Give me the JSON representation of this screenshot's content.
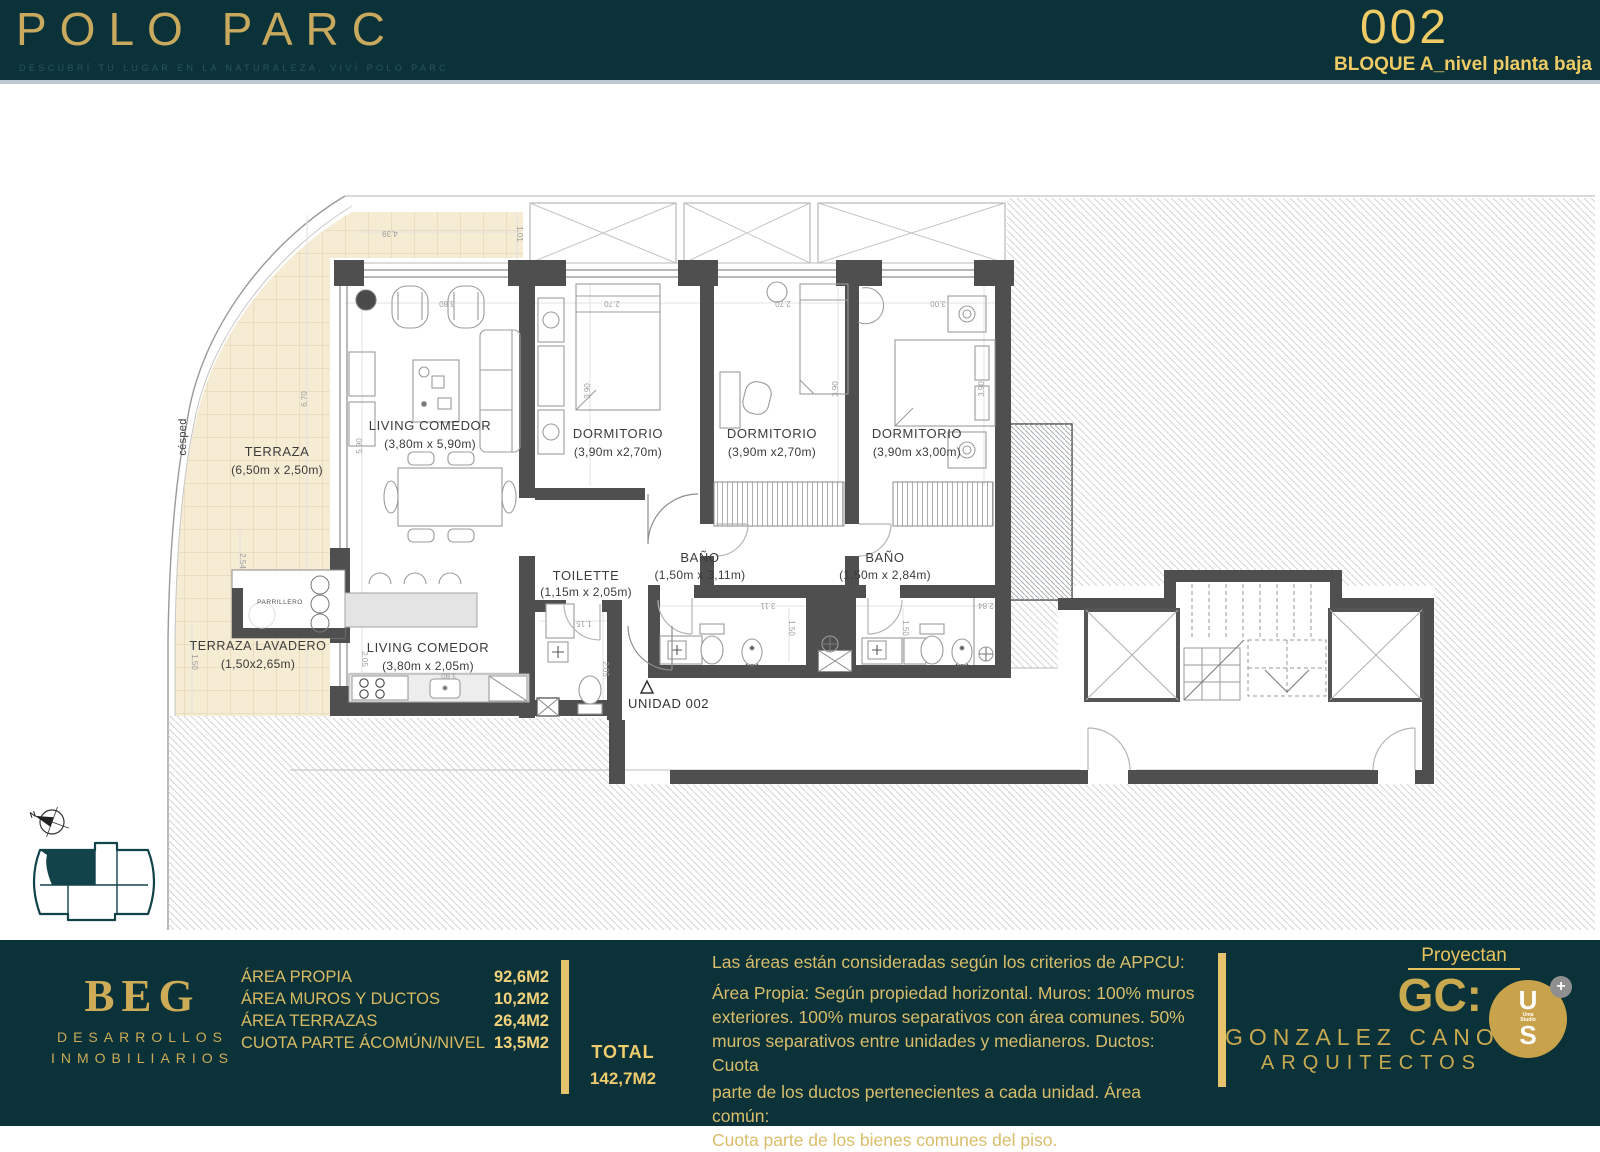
{
  "header": {
    "brand": "POLO PARC",
    "tagline": "DESCUBRÍ TU LUGAR EN LA NATURALEZA, VIVÍ POLO PARC.",
    "unit_number": "002",
    "block_label": "BLOQUE A_nivel planta baja"
  },
  "plan": {
    "rooms": {
      "terraza": {
        "name": "TERRAZA",
        "size": "(6,50m x 2,50m)"
      },
      "living": {
        "name": "LIVING COMEDOR",
        "size": "(3,80m x 5,90m)"
      },
      "dorm1": {
        "name": "DORMITORIO",
        "size": "(3,90m x2,70m)"
      },
      "dorm2": {
        "name": "DORMITORIO",
        "size": "(3,90m x2,70m)"
      },
      "dorm3": {
        "name": "DORMITORIO",
        "size": "(3,90m x3,00m)"
      },
      "toilette": {
        "name": "TOILETTE",
        "size": "(1,15m x 2,05m)"
      },
      "bano1": {
        "name": "BAÑO",
        "size": "(1,50m x 3,11m)"
      },
      "bano2": {
        "name": "BAÑO",
        "size": "(1,50m x 2,84m)"
      },
      "kitchen": {
        "name": "LIVING COMEDOR",
        "size": "(3,80m x 2,05m)"
      },
      "lavadero": {
        "name": "TERRAZA LAVADERO",
        "size": "(1,50x2,65m)"
      },
      "parrillero": {
        "name": "PARRILLERO"
      },
      "cesped": {
        "name": "césped"
      }
    },
    "unit_label": "UNIDAD 002",
    "compass_n": "N",
    "dims": [
      "4.39",
      "1.01",
      "3.80",
      "2.70",
      "2.70",
      "3.00",
      "6.70",
      "5.90",
      "3.90",
      "3.90",
      "3.90",
      "2.54",
      "1.50",
      "1.15",
      "2.05",
      "3.11",
      "1.50",
      "2.84",
      "1.50",
      "2.05",
      "3.80"
    ]
  },
  "footer": {
    "developer": {
      "name": "BEG",
      "line1": "DESARROLLOS",
      "line2": "INMOBILIARIOS"
    },
    "areas": [
      {
        "label": "ÁREA PROPIA",
        "value": "92,6M2"
      },
      {
        "label": "ÁREA MUROS Y DUCTOS",
        "value": "10,2M2"
      },
      {
        "label": "ÁREA TERRAZAS",
        "value": "26,4M2"
      },
      {
        "label": "CUOTA PARTE ÁCOMÚN/NIVEL",
        "value": "13,5M2"
      }
    ],
    "total": {
      "label": "TOTAL",
      "value": "142,7M2"
    },
    "note_lines": [
      "Las áreas están consideradas según los criterios de APPCU:",
      "Área Propia: Según propiedad horizontal. Muros: 100% muros",
      "exteriores. 100% muros separativos con área comunes. 50%",
      "muros separativos entre unidades y medianeros. Ductos: Cuota",
      "parte de los ductos pertenecientes a cada unidad. Área común:",
      "Cuota parte de los bienes comunes del piso."
    ],
    "architects": {
      "heading": "Proyectan",
      "gc": "GC:",
      "name1": "GONZALEZ CANO",
      "name2": "ARQUITECTOS",
      "badge": {
        "top": "U",
        "mid1": "Uma",
        "mid2": "Studio",
        "bottom": "S",
        "plus": "+"
      }
    }
  },
  "colors": {
    "teal": "#0a3238",
    "gold": "#d2b365",
    "gold_bright": "#eec964",
    "terrace_beige": "#f6ebd3"
  }
}
